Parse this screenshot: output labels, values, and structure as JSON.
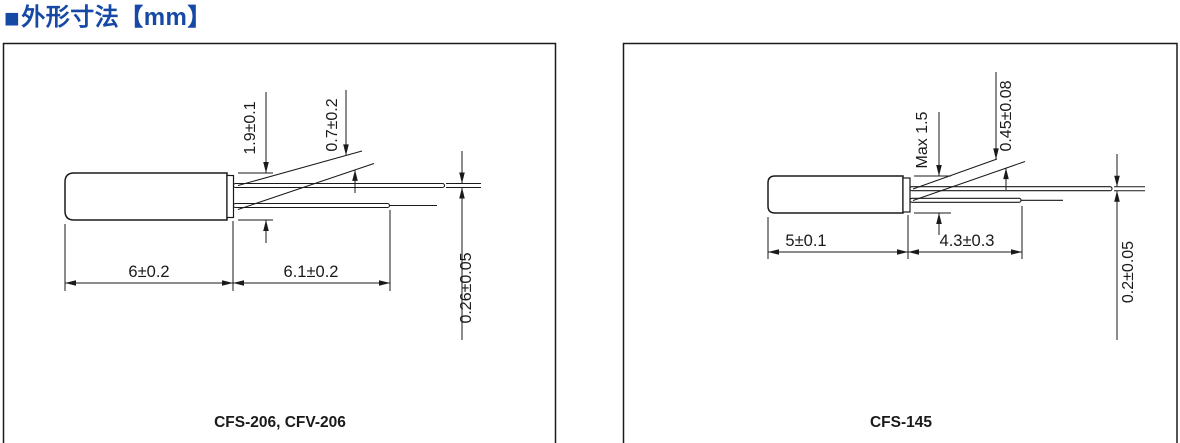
{
  "header": {
    "bullet": "■",
    "title": "外形寸法【mm】"
  },
  "panels": [
    {
      "caption": "CFS-206, CFV-206",
      "dims": {
        "diameter": "1.9±0.1",
        "lead_spacing": "0.7±0.2",
        "lead_diameter": "0.26±0.05",
        "body_length": "6±0.2",
        "lead_length": "6.1±0.2"
      }
    },
    {
      "caption": "CFS-145",
      "dims": {
        "diameter": "Max 1.5",
        "lead_spacing": "0.45±0.08",
        "lead_diameter": "0.2±0.05",
        "body_length": "5±0.1",
        "lead_length": "4.3±0.3"
      }
    }
  ],
  "colors": {
    "accent": "#1549a5",
    "line": "#1a1a1a"
  }
}
